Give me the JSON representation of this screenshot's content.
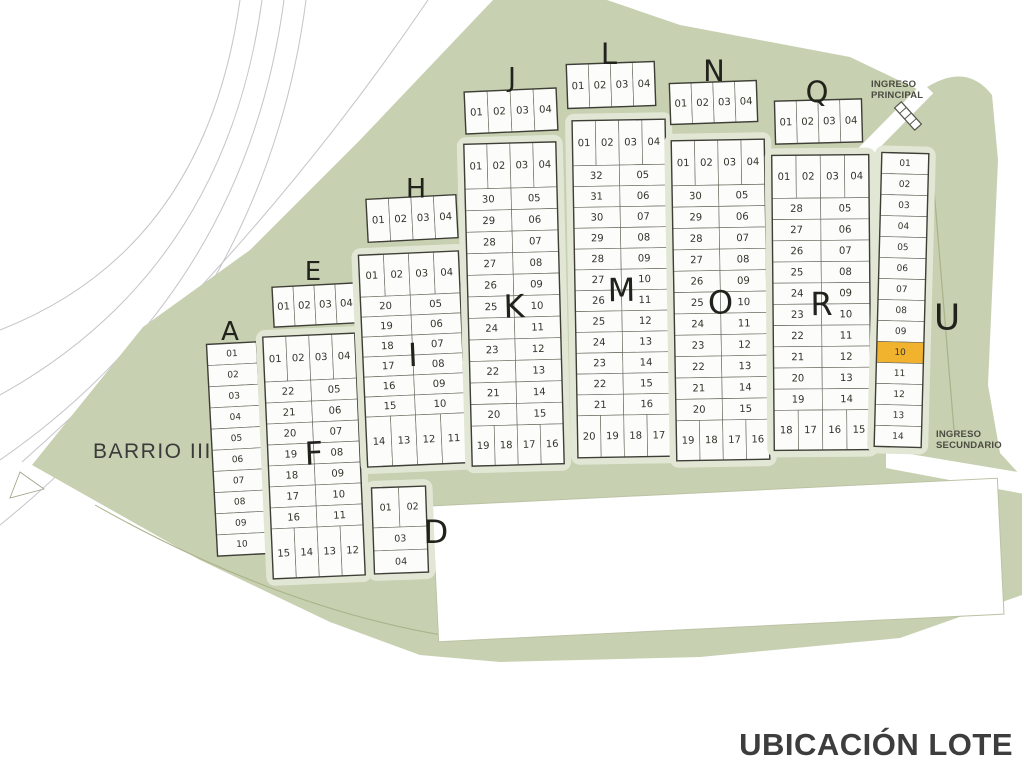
{
  "title": "UBICACIÓN LOTE",
  "site_label": "BARRIO III",
  "entrances": {
    "principal_l1": "INGRESO",
    "principal_l2": "PRINCIPAL",
    "secundario_l1": "INGRESO",
    "secundario_l2": "SECUNDARIO"
  },
  "highlight": {
    "block": "U",
    "lot": "10"
  },
  "colors": {
    "site_green": "#c7d0b0",
    "street": "#e2e7d5",
    "cell_fill": "#fcfcfa",
    "cell_stroke": "#6c6c62",
    "block_outline": "#3e3e36",
    "highlight_fill": "#f1b32e",
    "road_line": "#c4c4ca",
    "band_line": "#a9b289"
  },
  "blocks": [
    {
      "label": "A",
      "type": "column",
      "lots": [
        "01",
        "02",
        "03",
        "04",
        "05",
        "06",
        "07",
        "08",
        "09",
        "10"
      ]
    },
    {
      "label": "D",
      "type": "dblock",
      "lots": [
        "01",
        "02",
        "03",
        "04"
      ]
    },
    {
      "label": "E",
      "type": "strip",
      "lots": [
        "01",
        "02",
        "03",
        "04"
      ]
    },
    {
      "label": "F",
      "type": "ring",
      "top": [
        "01",
        "02",
        "03",
        "04"
      ],
      "left": [
        "22",
        "21",
        "20",
        "19",
        "18",
        "17",
        "16"
      ],
      "right": [
        "05",
        "06",
        "07",
        "08",
        "09",
        "10",
        "11"
      ],
      "bottom": [
        "15",
        "14",
        "13",
        "12"
      ]
    },
    {
      "label": "H",
      "type": "strip",
      "lots": [
        "01",
        "02",
        "03",
        "04"
      ]
    },
    {
      "label": "I",
      "type": "ring",
      "top": [
        "01",
        "02",
        "03",
        "04"
      ],
      "left": [
        "20",
        "19",
        "18",
        "17",
        "16",
        "15"
      ],
      "right": [
        "05",
        "06",
        "07",
        "08",
        "09",
        "10"
      ],
      "bottom": [
        "14",
        "13",
        "12",
        "11"
      ]
    },
    {
      "label": "J",
      "type": "strip",
      "lots": [
        "01",
        "02",
        "03",
        "04"
      ]
    },
    {
      "label": "K",
      "type": "ring",
      "top": [
        "01",
        "02",
        "03",
        "04"
      ],
      "left": [
        "30",
        "29",
        "28",
        "27",
        "26",
        "25",
        "24",
        "23",
        "22",
        "21",
        "20"
      ],
      "right": [
        "05",
        "06",
        "07",
        "08",
        "09",
        "10",
        "11",
        "12",
        "13",
        "14",
        "15"
      ],
      "bottom": [
        "19",
        "18",
        "17",
        "16"
      ]
    },
    {
      "label": "L",
      "type": "strip",
      "lots": [
        "01",
        "02",
        "03",
        "04"
      ]
    },
    {
      "label": "M",
      "type": "ring",
      "top": [
        "01",
        "02",
        "03",
        "04"
      ],
      "left": [
        "32",
        "31",
        "30",
        "29",
        "28",
        "27",
        "26",
        "25",
        "24",
        "23",
        "22",
        "21"
      ],
      "right": [
        "05",
        "06",
        "07",
        "08",
        "09",
        "10",
        "11",
        "12",
        "13",
        "14",
        "15",
        "16"
      ],
      "bottom": [
        "20",
        "19",
        "18",
        "17"
      ]
    },
    {
      "label": "N",
      "type": "strip",
      "lots": [
        "01",
        "02",
        "03",
        "04"
      ]
    },
    {
      "label": "O",
      "type": "ring",
      "top": [
        "01",
        "02",
        "03",
        "04"
      ],
      "left": [
        "30",
        "29",
        "28",
        "27",
        "26",
        "25",
        "24",
        "23",
        "22",
        "21",
        "20"
      ],
      "right": [
        "05",
        "06",
        "07",
        "08",
        "09",
        "10",
        "11",
        "12",
        "13",
        "14",
        "15"
      ],
      "bottom": [
        "19",
        "18",
        "17",
        "16"
      ]
    },
    {
      "label": "Q",
      "type": "strip",
      "lots": [
        "01",
        "02",
        "03",
        "04"
      ]
    },
    {
      "label": "R",
      "type": "ring",
      "top": [
        "01",
        "02",
        "03",
        "04"
      ],
      "left": [
        "28",
        "27",
        "26",
        "25",
        "24",
        "23",
        "22",
        "21",
        "20",
        "19"
      ],
      "right": [
        "05",
        "06",
        "07",
        "08",
        "09",
        "10",
        "11",
        "12",
        "13",
        "14"
      ],
      "bottom": [
        "18",
        "17",
        "16",
        "15"
      ]
    },
    {
      "label": "U",
      "type": "column",
      "lots": [
        "01",
        "02",
        "03",
        "04",
        "05",
        "06",
        "07",
        "08",
        "09",
        "10",
        "11",
        "12",
        "13",
        "14"
      ],
      "highlight": "10"
    }
  ]
}
